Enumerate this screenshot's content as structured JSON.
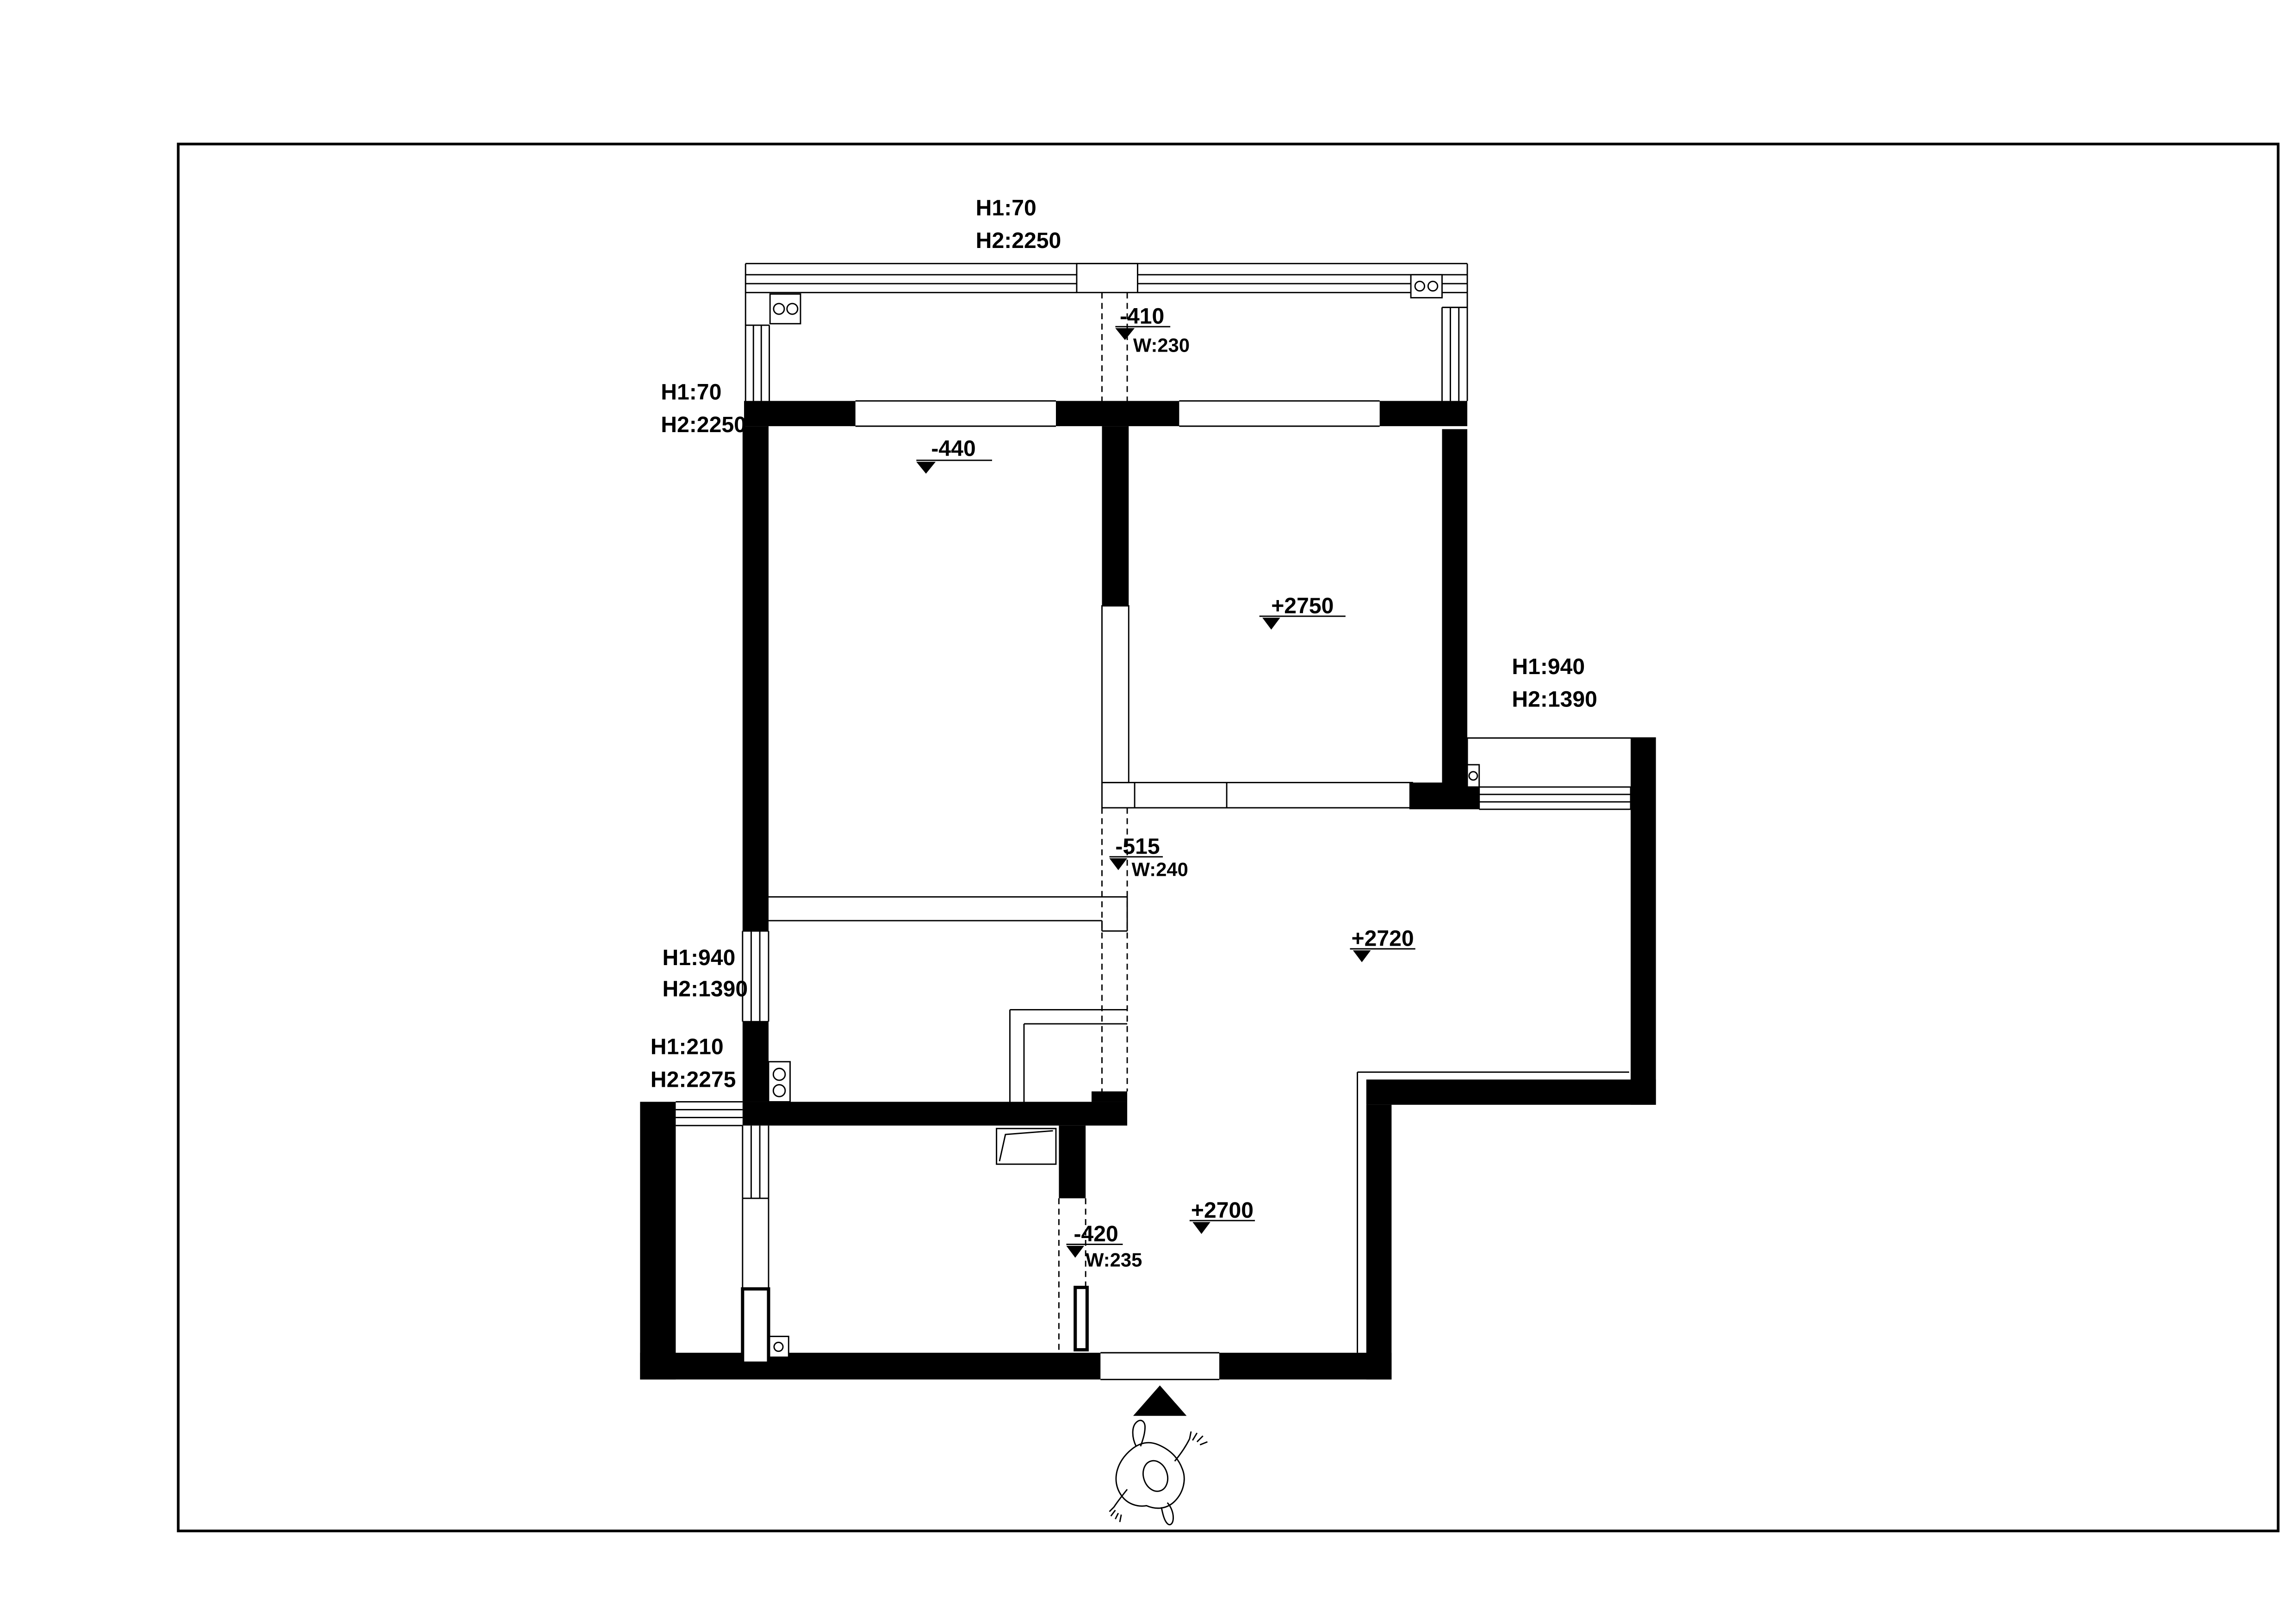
{
  "annotations": {
    "balcony_top": {
      "h1": "H1:70",
      "h2": "H2:2250"
    },
    "balcony_left": {
      "h1": "H1:70",
      "h2": "H2:2250"
    },
    "bay_right": {
      "h1": "H1:940",
      "h2": "H2:1390"
    },
    "window_left": {
      "h1": "H1:940",
      "h2": "H2:1390"
    },
    "window_left_low": {
      "h1": "H1:210",
      "h2": "H2:2275"
    },
    "beam_top": {
      "drop": "-440"
    },
    "beam_balcony": {
      "drop": "-410",
      "width": "W:230"
    },
    "beam_mid": {
      "drop": "-515",
      "width": "W:240"
    },
    "beam_entry": {
      "drop": "-420",
      "width": "W:235"
    },
    "level_bedroom": "+2750",
    "level_dining": "+2720",
    "level_entry": "+2700"
  }
}
